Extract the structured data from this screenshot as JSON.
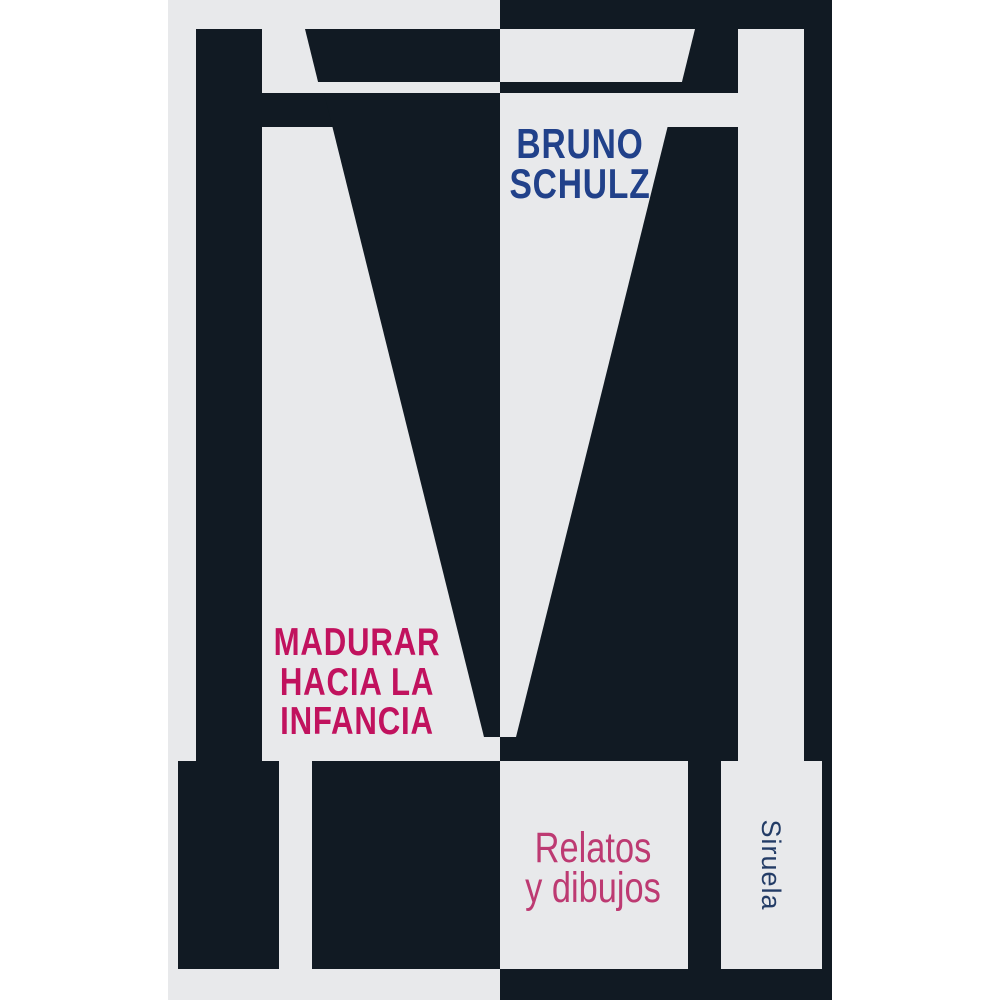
{
  "cover": {
    "author": {
      "line1": "BRUNO",
      "line2": "SCHULZ"
    },
    "title": {
      "line1": "MADURAR",
      "line2": "HACIA LA",
      "line3": "INFANCIA"
    },
    "subtitle": {
      "line1": "Relatos",
      "line2": "y dibujos"
    },
    "publisher": "Siruela"
  },
  "colors": {
    "navy": "#111a23",
    "paper": "#e8e9eb",
    "page-white": "#ffffff",
    "author-blue": "#21418a",
    "title-crimson": "#c1125e",
    "subtitle-pink": "#bd3a72",
    "publisher-blue": "#233c66"
  }
}
